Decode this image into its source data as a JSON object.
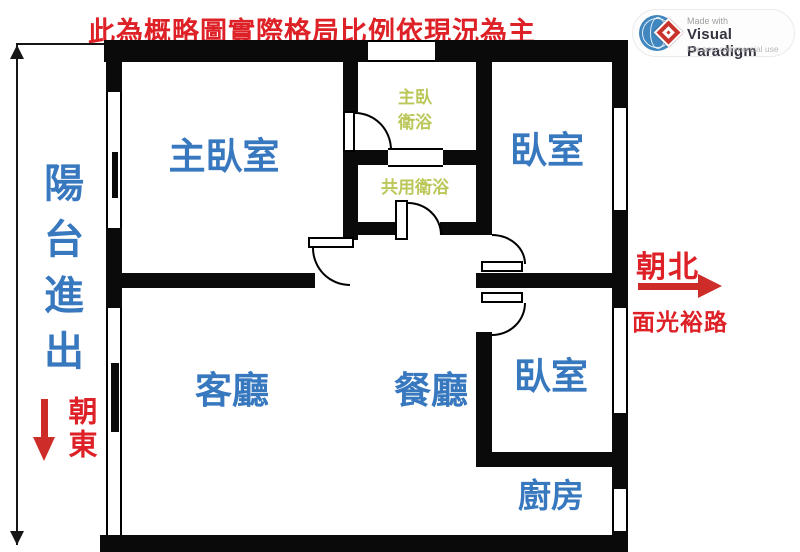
{
  "title": "此為概略圖實際格局比例依現況為主",
  "badge": {
    "made_with": "Made with",
    "brand": "Visual Paradigm",
    "license": "For non-commercial use"
  },
  "rooms": {
    "balcony": "陽台進出",
    "master_bedroom": "主臥室",
    "master_bath_line1": "主臥",
    "master_bath_line2": "衛浴",
    "shared_bath": "共用衛浴",
    "bedroom_top": "臥室",
    "living_room": "客廳",
    "dining_room": "餐廳",
    "bedroom_bottom": "臥室",
    "kitchen": "廚房"
  },
  "compass": {
    "east": "朝東",
    "north": "朝北",
    "road": "面光裕路"
  },
  "colors": {
    "wall": "#0a0a0a",
    "blue": "#3878bf",
    "olive": "#bcc75a",
    "red": "#dd2127",
    "red-arrow": "#cd2c28",
    "brand-navy": "#343440"
  }
}
